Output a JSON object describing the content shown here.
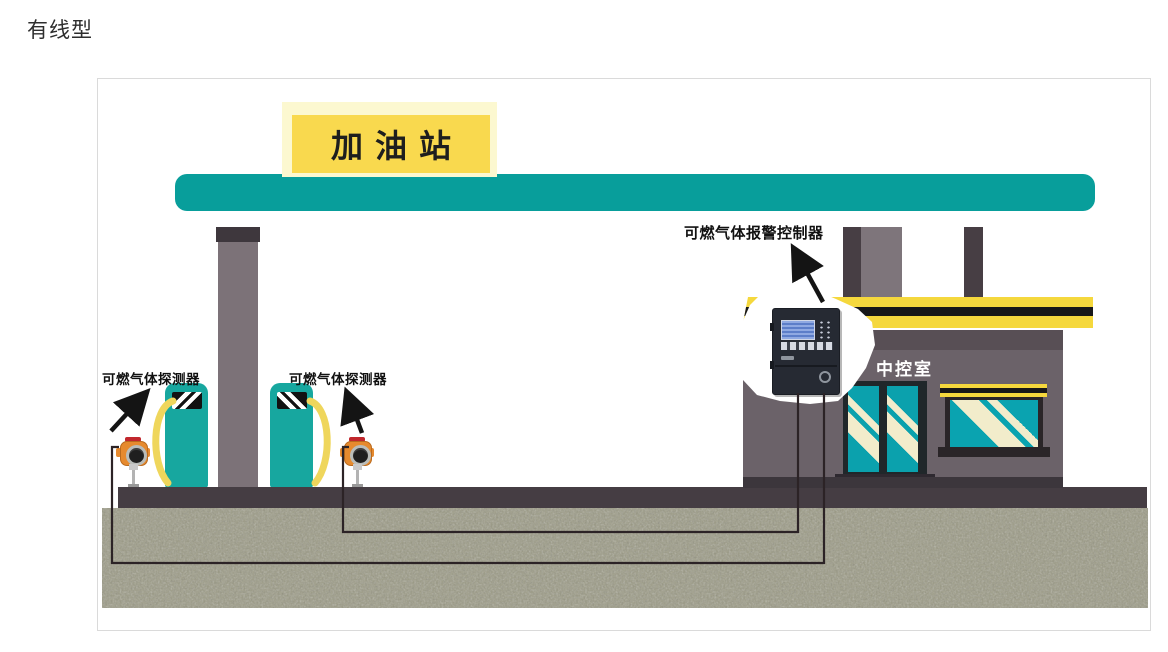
{
  "page": {
    "title": "有线型"
  },
  "scene": {
    "station_sign": "加油站",
    "control_room": "中控室",
    "labels": {
      "detector_left": "可燃气体探测器",
      "detector_right": "可燃气体探测器",
      "controller": "可燃气体报警控制器"
    },
    "colors": {
      "canopy_teal": "#089e9b",
      "sign_yellow": "#f9d94e",
      "sign_glow": "#fcf8d0",
      "roof_band_yellow": "#f5d83d",
      "pump_teal": "#17a79f",
      "hose_yellow": "#efd65c",
      "glass_teal": "#0ba1ad",
      "glass_stripe_cream": "#f2eccb",
      "wall_gray": "#6b6269",
      "column_gray": "#7c7278",
      "platform_dark": "#453d43",
      "soil_gray_green": "#9b9a84",
      "detector_orange": "#e68a2e",
      "wire_black": "#2c2326",
      "controller_body": "#262a33"
    }
  }
}
